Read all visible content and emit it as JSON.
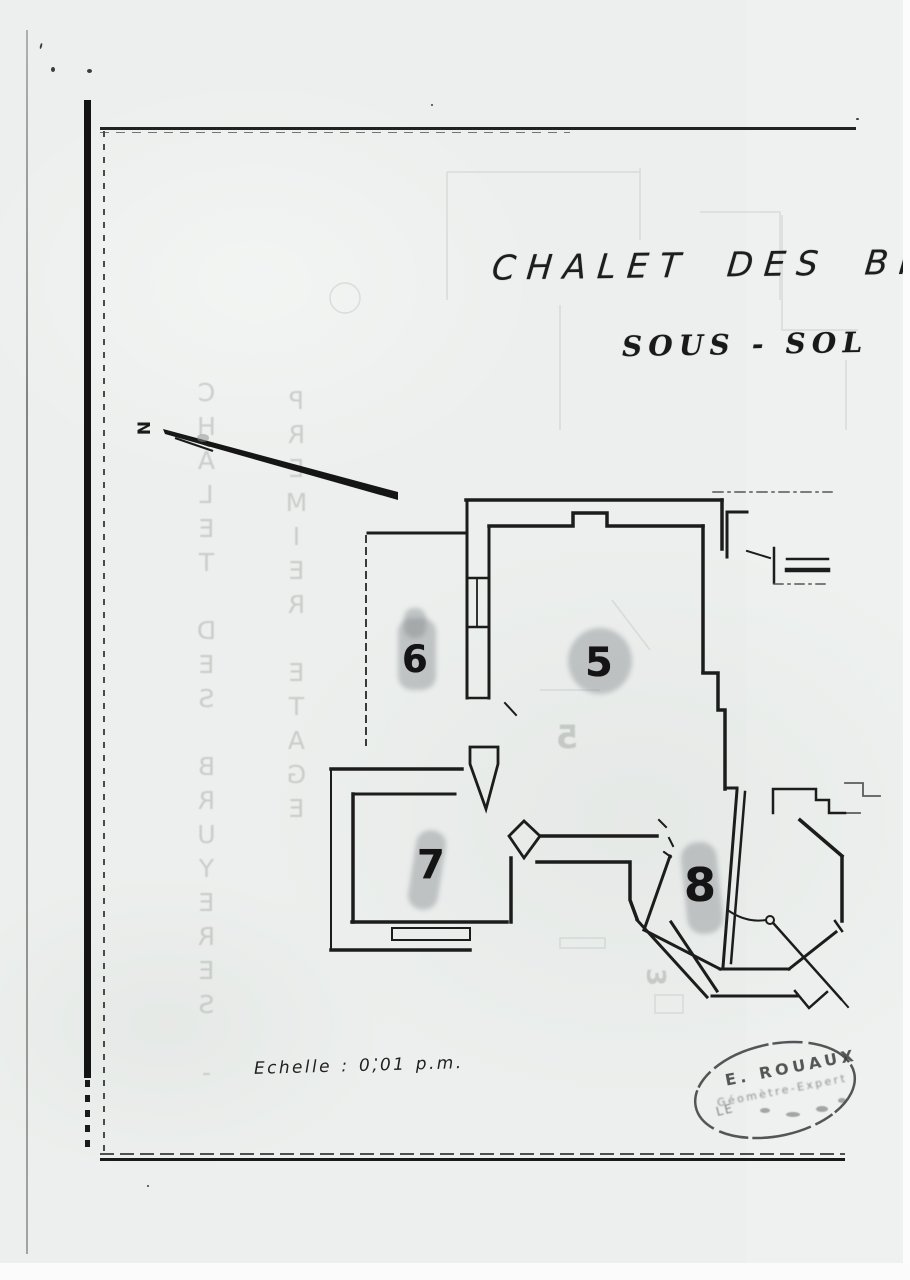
{
  "page": {
    "background_color": "#edefec",
    "ink_color": "#1b1b1b",
    "smudge_color": "#7d8288"
  },
  "doc": {
    "title": "CHALET DES BRU",
    "subtitle": "SOUS - SOL",
    "scale": "Echelle : 0,01 p.m.",
    "north": "N",
    "rooms": [
      {
        "number": "5"
      },
      {
        "number": "6"
      },
      {
        "number": "7"
      },
      {
        "number": "8"
      }
    ],
    "stamp": {
      "line1": "E. ROUAUX",
      "line2": "Géomètre-Expert",
      "line3": "LE"
    },
    "bleed": {
      "col1": "CHALET DES BRUYERES -",
      "col2": "PREMIER ETAGE",
      "ghost_room_5": "5",
      "ghost_room_3": "3"
    }
  }
}
